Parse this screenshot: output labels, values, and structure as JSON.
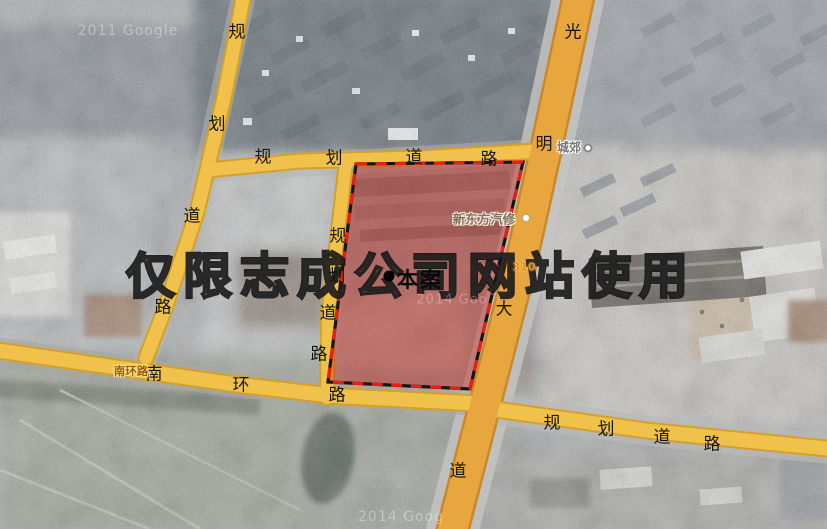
{
  "map": {
    "watermarks": {
      "main": "仅限志成公司网站使用",
      "google_top_left": "2011 Google",
      "google_center": "2014 Goo",
      "google_bottom": "2014 Goog"
    },
    "site": {
      "label": "本案"
    },
    "roads": [
      {
        "id": "planned-road-top",
        "name": "规划道路",
        "chars": [
          {
            "t": "规",
            "x": 263,
            "y": 158
          },
          {
            "t": "划",
            "x": 334,
            "y": 159
          },
          {
            "t": "道",
            "x": 414,
            "y": 158
          },
          {
            "t": "路",
            "x": 489,
            "y": 160
          }
        ]
      },
      {
        "id": "planned-road-left-diagonal",
        "name": "规划道路",
        "chars": [
          {
            "t": "规",
            "x": 237,
            "y": 33
          },
          {
            "t": "划",
            "x": 217,
            "y": 125
          },
          {
            "t": "道",
            "x": 192,
            "y": 217
          },
          {
            "t": "路",
            "x": 163,
            "y": 308
          }
        ]
      },
      {
        "id": "planned-road-middle-vertical",
        "name": "规划道路",
        "chars": [
          {
            "t": "规",
            "x": 338,
            "y": 237
          },
          {
            "t": "划",
            "x": 337,
            "y": 277
          },
          {
            "t": "道",
            "x": 328,
            "y": 314
          },
          {
            "t": "路",
            "x": 319,
            "y": 355
          }
        ]
      },
      {
        "id": "south-ring-road",
        "name": "南环路",
        "chars": [
          {
            "t": "南",
            "x": 154,
            "y": 375
          },
          {
            "t": "环",
            "x": 241,
            "y": 386
          },
          {
            "t": "路",
            "x": 337,
            "y": 396
          }
        ]
      },
      {
        "id": "planned-road-bottom-right",
        "name": "规划道路",
        "chars": [
          {
            "t": "规",
            "x": 552,
            "y": 424
          },
          {
            "t": "划",
            "x": 606,
            "y": 430
          },
          {
            "t": "道",
            "x": 662,
            "y": 438
          },
          {
            "t": "路",
            "x": 712,
            "y": 445
          }
        ]
      },
      {
        "id": "guangming-avenue",
        "name": "光明大道",
        "chars": [
          {
            "t": "光",
            "x": 573,
            "y": 33
          },
          {
            "t": "明",
            "x": 544,
            "y": 145
          },
          {
            "t": "大",
            "x": 504,
            "y": 310
          },
          {
            "t": "道",
            "x": 458,
            "y": 472
          }
        ]
      }
    ],
    "poi": [
      {
        "id": "town-label-chengjiao",
        "text": "城郊",
        "x": 569,
        "y": 147,
        "style": "poi-gray"
      },
      {
        "id": "business-label-xindongfang",
        "text": "新东方汽修",
        "x": 484,
        "y": 218,
        "style": "poi-biz"
      },
      {
        "id": "roadname-label-nanhuanlu",
        "text": "南环路",
        "x": 131,
        "y": 371,
        "style": "poi-roadname"
      },
      {
        "id": "route-number-310",
        "text": "310",
        "x": 524,
        "y": 267,
        "style": "poi-route"
      }
    ],
    "small_watermarks": [
      {
        "id": "google-watermark-top-left",
        "key": "google_top_left",
        "x": 128,
        "y": 31,
        "cls": ""
      },
      {
        "id": "google-watermark-center",
        "key": "google_center",
        "x": 452,
        "y": 300,
        "cls": "reddish"
      },
      {
        "id": "google-watermark-bottom",
        "key": "google_bottom",
        "x": 401,
        "y": 517,
        "cls": ""
      }
    ],
    "markers": [
      {
        "id": "town-poi-marker",
        "x": 588,
        "y": 148,
        "size": 9,
        "bg": "#ffffff",
        "border": "2px solid #8a8a8a"
      },
      {
        "id": "business-poi-marker",
        "x": 526,
        "y": 218,
        "size": 8,
        "bg": "#ffffff",
        "border": "1.5px solid #b0a79a"
      }
    ],
    "colors": {
      "minor_road_fill": "#f0c24c",
      "minor_road_casing": "#d4a02c",
      "avenue_fill": "#e8a63e",
      "avenue_casing": "#c9882b",
      "site_zone_fill": "rgba(198,44,38,0.45)",
      "site_zone_dash_red": "#e81f12",
      "site_zone_dash_dark": "#141414"
    }
  }
}
